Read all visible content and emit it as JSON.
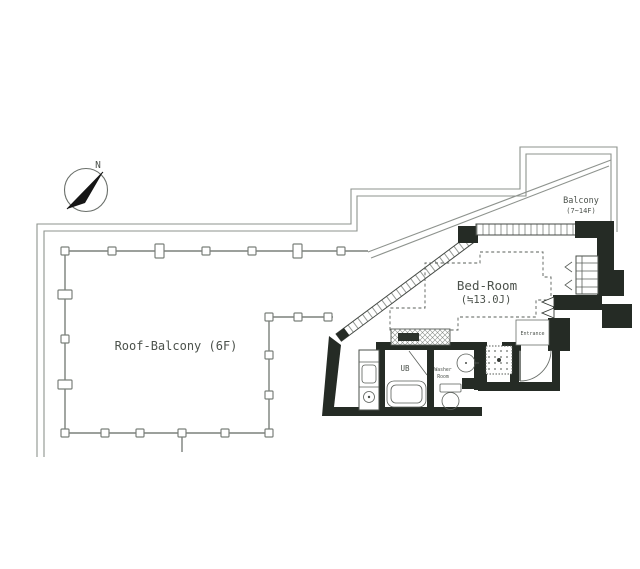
{
  "plan": {
    "compass": {
      "label": "N"
    },
    "roof_balcony": {
      "label": "Roof-Balcony (6F)"
    },
    "balcony": {
      "label": "Balcony",
      "floors": "(7~14F)"
    },
    "bedroom": {
      "label": "Bed-Room",
      "size": "(≒13.0J)"
    },
    "bath": {
      "label": "UB"
    },
    "washer_room": {
      "line1": "Washer",
      "line2": "Room"
    },
    "entrance": {
      "label": "Entrance"
    }
  },
  "colors": {
    "wall": "#252b25",
    "outline": "#8e938e",
    "railing": "#7b807b",
    "text": "#4c524c",
    "background": "#ffffff"
  }
}
